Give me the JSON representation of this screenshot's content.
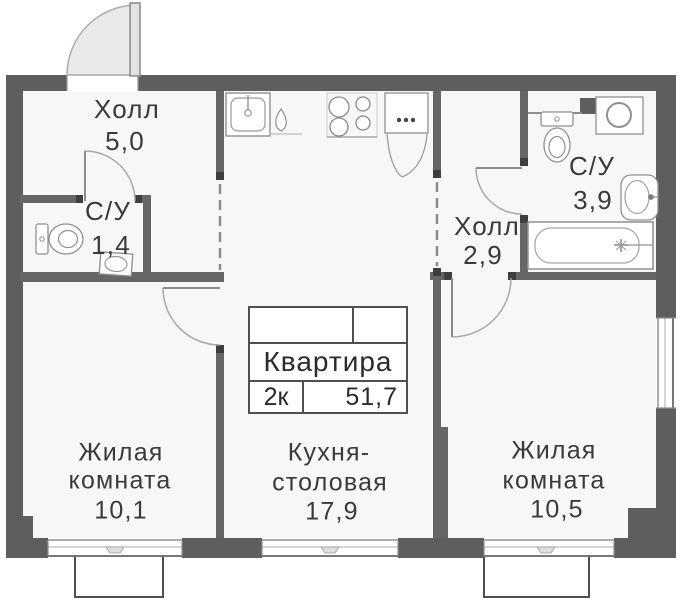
{
  "plan": {
    "title_block": {
      "name": "Квартира",
      "rooms_count": "2к",
      "total_area": "51,7"
    },
    "rooms": [
      {
        "name": "Холл",
        "area": "5,0"
      },
      {
        "name": "С/У",
        "area": "1,4"
      },
      {
        "name": "Холл",
        "area": "2,9"
      },
      {
        "name": "С/У",
        "area": "3,9"
      },
      {
        "name": "Жилая",
        "name_line2": "комната",
        "area": "10,1"
      },
      {
        "name": "Кухня-",
        "name_line2": "столовая",
        "area": "17,9"
      },
      {
        "name": "Жилая",
        "name_line2": "комната",
        "area": "10,5"
      }
    ],
    "fixtures": [
      "entrance-door",
      "kitchen-sink",
      "dishwasher",
      "stove",
      "refrigerator",
      "toilet",
      "hand-sink",
      "washing-machine",
      "bathtub",
      "window",
      "balcony"
    ],
    "colors": {
      "wall": "#5e5e5e",
      "floor": "#f7f7f7",
      "outline": "#909090",
      "text": "#3a3a3a",
      "door_fill": "#e9e9e9"
    }
  }
}
